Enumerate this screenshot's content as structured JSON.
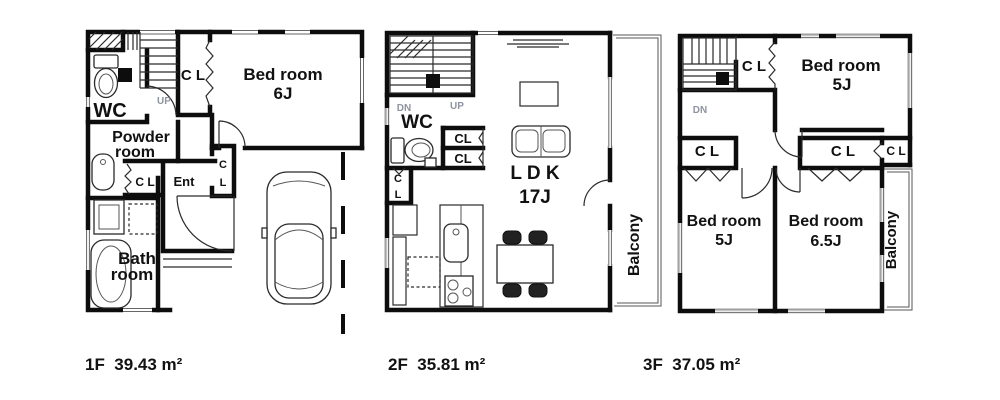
{
  "floors": [
    {
      "name": "1F",
      "area_label": "1F  39.43 m²",
      "labels": {
        "cl_top": "C L",
        "bedroom1": "Bed room",
        "bedroom2": "6J",
        "up": "UP",
        "wc": "WC",
        "powder1": "Powder",
        "powder2": "room",
        "cl_ent": "C L",
        "ent": "Ent",
        "cl_c": "C",
        "cl_l": "L",
        "bath1": "Bath",
        "bath2": "room"
      }
    },
    {
      "name": "2F",
      "area_label": "2F  35.81 m²",
      "labels": {
        "dn": "DN",
        "up": "UP",
        "wc": "WC",
        "cl1": "CL",
        "cl2": "CL",
        "cl_c": "C",
        "cl_l": "L",
        "ldk1": "L D K",
        "ldk2": "17J",
        "balcony": "Balcony"
      }
    },
    {
      "name": "3F",
      "area_label": "3F  37.05 m²",
      "labels": {
        "dn": "DN",
        "cl_top": "C L",
        "bed_top1": "Bed room",
        "bed_top2": "5J",
        "cl_left": "C L",
        "cl_mid": "C L",
        "cl_right": "C L",
        "bed_left1": "Bed room",
        "bed_left2": "5J",
        "bed_right1": "Bed room",
        "bed_right2": "6.5J",
        "balcony": "Balcony"
      }
    }
  ]
}
